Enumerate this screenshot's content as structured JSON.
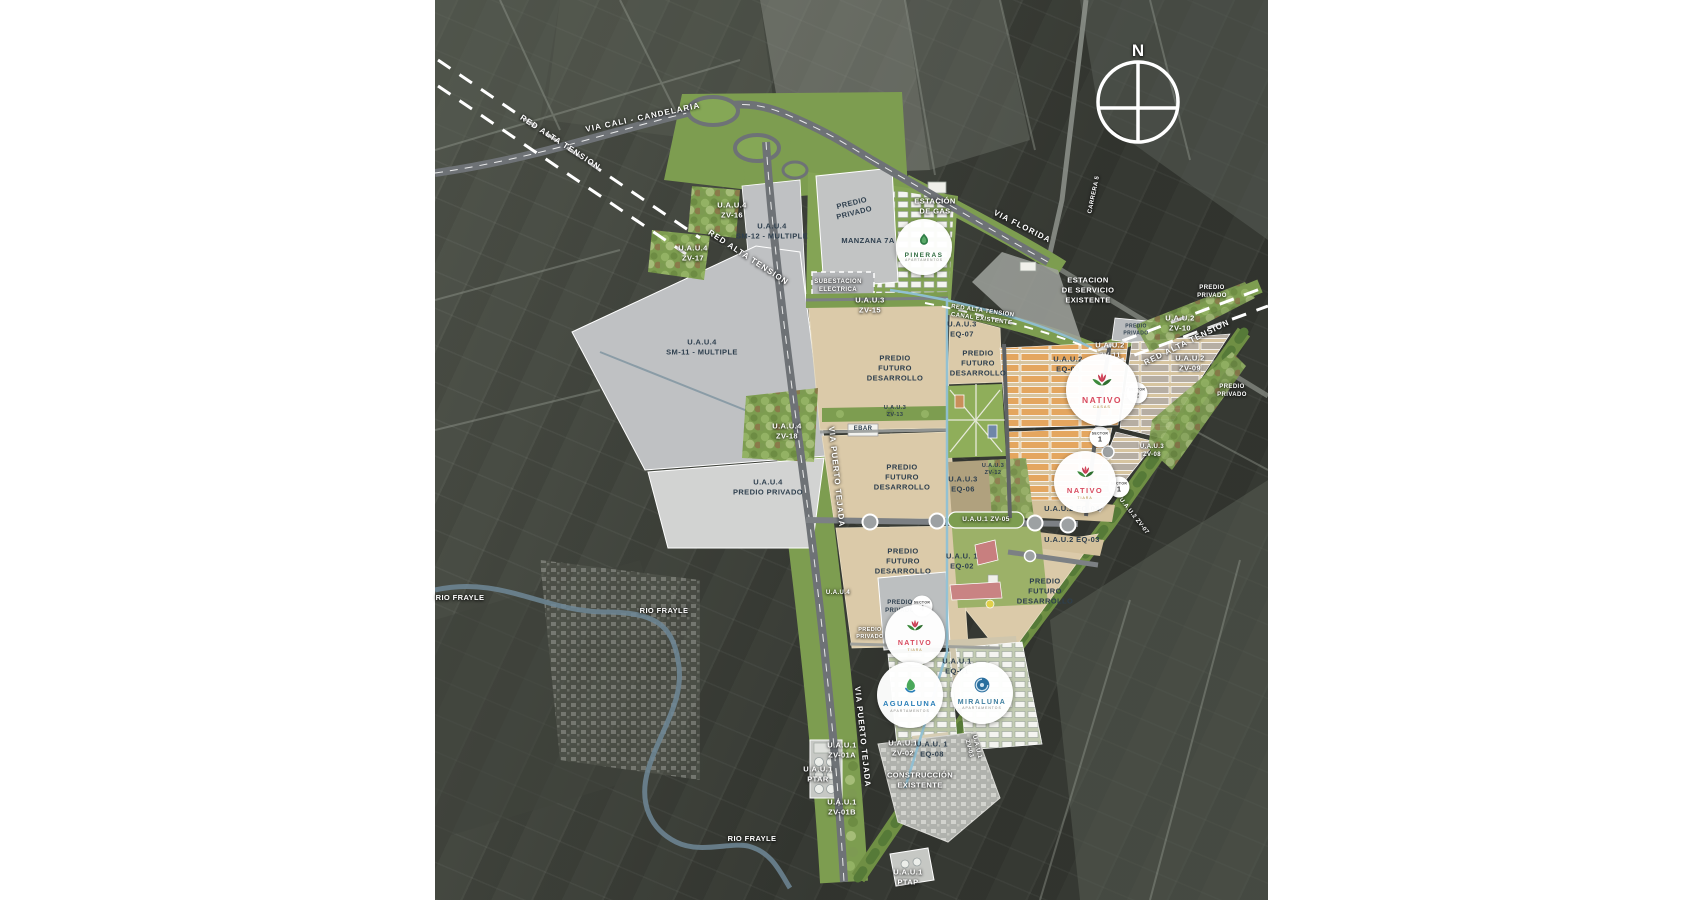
{
  "map_title": "Plan maestro urbanistico - Candelaria",
  "colors": {
    "plan_green": "#7d9d50",
    "parcel_tan": "#dbcaa9",
    "parcel_gray": "#bfc1c3",
    "housing_orange": "#e4a65f",
    "canal_blue": "#8fc0d4",
    "road_gray": "#6e7276",
    "nativo_red": "#d84a5f",
    "pineras_green": "#2f7d46",
    "agualuna_blue": "#2a7fb8",
    "miraluna_blue": "#2a6f9e"
  },
  "labels": {
    "via_cali": "VIA CALI - CANDELARIA",
    "red_alta_tension": "RED ALTA TENSION",
    "red_alta_tension_canal": "RED ALTA TENSION\nCANAL EXISTENTE",
    "via_florida": "VIA FLORIDA",
    "via_puerto_tejada": "VIA PUERTO TEJADA",
    "carrera5": "CARRERA 5",
    "estacion_gas": "ESTACIÓN\nDE GAS",
    "estacion_servicio": "ESTACION\nDE SERVICIO\nEXISTENTE",
    "subestacion": "SUBESTACION\nELECTRICA",
    "manzana_7a": "MANZANA 7A",
    "predio_privado": "PREDIO\nPRIVADO",
    "predio_futuro": "PREDIO\nFUTURO\nDESARROLLO",
    "uau4_predio_privado": "U.A.U.4\nPREDIO PRIVADO",
    "uau4": "U.A.U.4",
    "uau4_zv16": "U.A.U.4\nZV-16",
    "uau4_zv17": "U.A.U.4\nZV-17",
    "uau4_zv18": "U.A.U.4\nZV-18",
    "uau4_sm11": "U.A.U.4\nSM-11 - MULTIPLE",
    "uau4_sm12": "U.A.U.4\nSM-12 - MULTIPLE",
    "uau3_zv15": "U.A.U.3\nZV-15",
    "uau3_zv13": "U.A.U.3\nZV-13",
    "uau3_zv12": "U.A.U.3\nZV-12",
    "uau3_zv08": "U.A.U.3\nZV-08",
    "uau3_eq07": "U.A.U.3\nEQ-07",
    "uau3_eq06": "U.A.U.3\nEQ-06",
    "uau2_zv10": "U.A.U.2\nZV-10",
    "uau2_zv11": "U.A.U.2\nZV-11",
    "uau2_zv09": "U.A.U.2\nZV-09",
    "uau2_zv07": "U.A.U.2  ZV-07",
    "uau2_eq05": "U.A.U.2\nEQ-05",
    "uau2_eq04": "U.A.U.2      EQ-04",
    "uau2_eq03": "U.A.U.2      EQ-03",
    "uau1_zv05": "U.A.U.1        ZV-05",
    "uau1_eq02": "U.A.U. 1\nEQ-02",
    "uau1_eq01": "U.A.U.1\nEQ-01",
    "uau1_eq08": "U.A.U. 1\nEQ-08",
    "uau1_zv01a": "U.A.U.1\nZV-01A",
    "uau1_zv01b": "U.A.U.1\nZV-01B",
    "uau1_zv02": "U.A.U.1\nZV-02",
    "uau1_zv03": "U.A.U.1\nZV-03",
    "uau1_ptar": "U.A.U.1\nPTAR",
    "uau1_ptap": "U.A.U.1\nPTAP",
    "ebar": "EBAR",
    "construccion": "CONSTRUCCIÓN\nEXISTENTE",
    "rio_frayle": "RIO FRAYLE",
    "north": "N"
  },
  "logos": {
    "pineras": {
      "name": "PINERAS",
      "subtitle": "APARTAMENTOS"
    },
    "nativo_casas": {
      "name": "NATIVO",
      "subtitle": "CASAS"
    },
    "nativo_tiara": {
      "name": "NATIVO",
      "subtitle": "TIARA"
    },
    "agualuna": {
      "name": "AGUALUNA",
      "subtitle": "APARTAMENTOS"
    },
    "miraluna": {
      "name": "MIRALUNA",
      "subtitle": "APARTAMENTOS"
    }
  },
  "badges": {
    "word": "SECTOR",
    "n1": "1",
    "n2": "2",
    "n4": "4"
  }
}
